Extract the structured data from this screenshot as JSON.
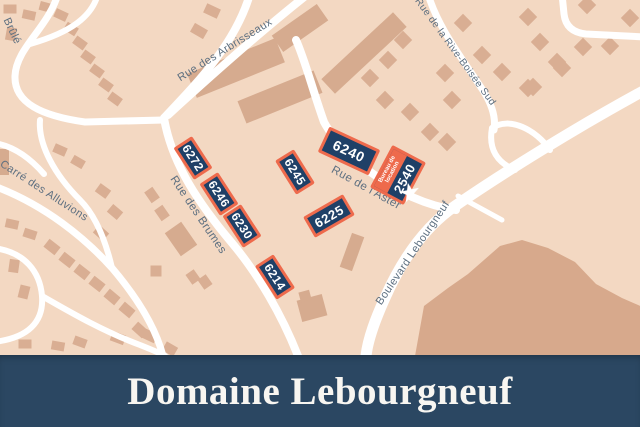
{
  "banner": {
    "title": "Domaine Lebourgneuf"
  },
  "map": {
    "streets": [
      {
        "name": "Brûlé"
      },
      {
        "name": "Carré des Alluvions"
      },
      {
        "name": "Rue des Arbrisseaux"
      },
      {
        "name": "Rue de la Rive-Boisée Sud"
      },
      {
        "name": "Rue des Brumes"
      },
      {
        "name": "Rue de l'Aster"
      },
      {
        "name": "Boulevard Lebourgneuf"
      }
    ],
    "lots": [
      {
        "number": "6272"
      },
      {
        "number": "6246"
      },
      {
        "number": "6230"
      },
      {
        "number": "6214"
      },
      {
        "number": "6245"
      },
      {
        "number": "6225"
      },
      {
        "number": "6240"
      },
      {
        "number": "2540",
        "tag": "Bureau de location"
      }
    ],
    "star_icon": "★",
    "colors": {
      "map_background": "#f3d8c2",
      "road": "#ffffff",
      "house": "#d9ae93",
      "building": "#d6ab8f",
      "terrain": "#d7a98c",
      "lot_fill": "#1f4067",
      "lot_border": "#ee6a4c",
      "street_text": "#5d6f80",
      "banner_background": "#2b4762",
      "banner_text": "#f8f6f1"
    }
  }
}
